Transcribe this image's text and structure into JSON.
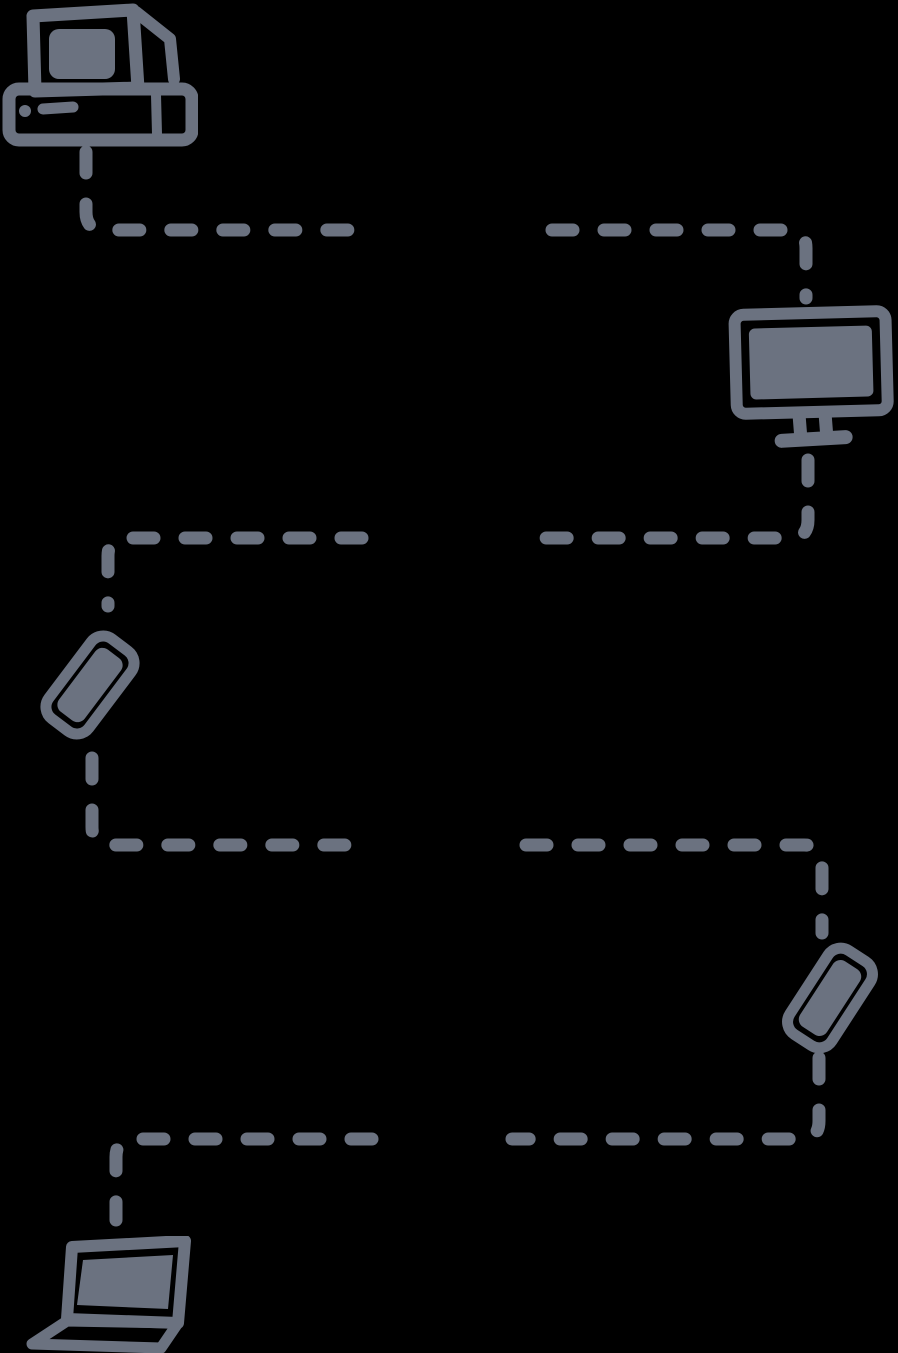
{
  "colors": {
    "background": "#000000",
    "ink": "#6b7280"
  },
  "diagram": {
    "type": "device-network-diagram",
    "nodes": [
      {
        "id": "desktop-computer",
        "icon": "retro-desktop-computer-icon",
        "position": "top-left"
      },
      {
        "id": "monitor",
        "icon": "monitor-icon",
        "position": "upper-right"
      },
      {
        "id": "smartphone-left",
        "icon": "smartphone-icon",
        "position": "middle-left",
        "tilt": "rotated-clockwise"
      },
      {
        "id": "smartphone-right",
        "icon": "smartphone-icon",
        "position": "lower-right",
        "tilt": "rotated-clockwise"
      },
      {
        "id": "laptop",
        "icon": "laptop-icon",
        "position": "bottom-left"
      }
    ],
    "edges": [
      {
        "from": "desktop-computer",
        "to": "monitor",
        "style": "dashed-elbow"
      },
      {
        "from": "monitor",
        "to": "smartphone-left",
        "style": "dashed-elbow"
      },
      {
        "from": "smartphone-left",
        "to": "smartphone-right",
        "style": "dashed-elbow"
      },
      {
        "from": "smartphone-right",
        "to": "laptop",
        "style": "dashed-elbow"
      }
    ]
  }
}
